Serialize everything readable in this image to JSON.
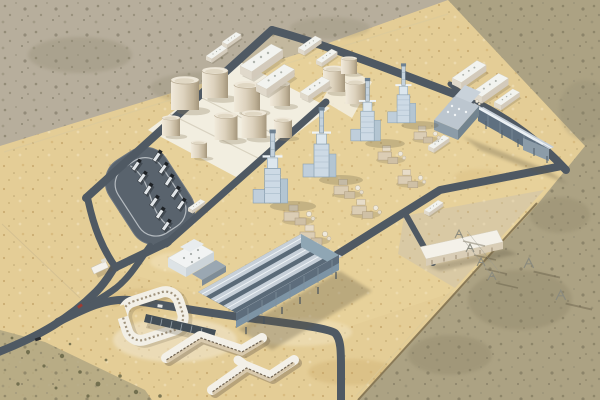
{
  "scene": {
    "description": "High-oblique aerial 3D rendering of a combined-cycle power plant complex in a tan desert: graded sand apron with dark internal road grid, cream storage-tank farm, four light steel-blue HRSG boiler units with tall stacks, two blue-gray ridged-roof condenser halls, small white warehouses, a gravel electrical switchyard with gantry rows, horseshoe-shaped cream administration buildings, a truck parking loop and a forked access road exiting bottom-left.",
    "style": "architectural visualization render, no text or UI elements",
    "camera": "high oblique aerial view, light from upper-left, shadows cast to lower-right"
  },
  "regions": {
    "outer_desert": {
      "label": "undisturbed gray-taupe desert",
      "position": "top and lower-right"
    },
    "sand_apron": {
      "label": "graded golden sand plant site",
      "position": "diagonal central band"
    },
    "tank_farm": {
      "label": "fuel storage tank farm on white bunded pad",
      "position": "upper-left of plot"
    },
    "power_blocks": {
      "label": "HRSG boiler and stack units with tan auxiliary equipment",
      "position": "center diagonal row"
    },
    "condenser_hall_east": {
      "label": "elevated ridged-roof hall with head house",
      "position": "right"
    },
    "condenser_hall_center": {
      "label": "large elevated ridged-roof hall with white office block",
      "position": "center-bottom"
    },
    "switchyard": {
      "label": "electrical switchyard gravel pad with control building and gantries",
      "position": "lower-center-right"
    },
    "admin_campus": {
      "label": "horseshoe ring building, canopy and two zigzag blocks",
      "position": "lower-left"
    },
    "truck_parking": {
      "label": "asphalt loop with parked semi-trailer trucks",
      "position": "left"
    },
    "access_road": {
      "label": "forked access road with gatehouse and cars",
      "position": "bottom-left corner"
    }
  },
  "counts": {
    "storage_tanks": 12,
    "hrsg_stack_units": 4,
    "aux_equipment_clusters": 7,
    "ridged_roof_halls": 2,
    "small_white_warehouses": 10,
    "admin_buildings": 4,
    "switchyard_gantry_rows": 4,
    "parked_trucks": 11,
    "road_vehicles": 3,
    "transmission_towers": 2
  },
  "palette": {
    "sand": "#e4cd96",
    "desert": "#b7ae9c",
    "desert_olive": "#aca283",
    "road": "#4f5963",
    "pad_white": "#f2eee0",
    "tank_cream": "#ddd2bd",
    "steel_blue": "#cddae5",
    "hall_roof": "#c6cfd8",
    "hall_wall": "#5d6d7c",
    "admin_wall": "#dccfb6",
    "shadow": "#5f5742"
  }
}
